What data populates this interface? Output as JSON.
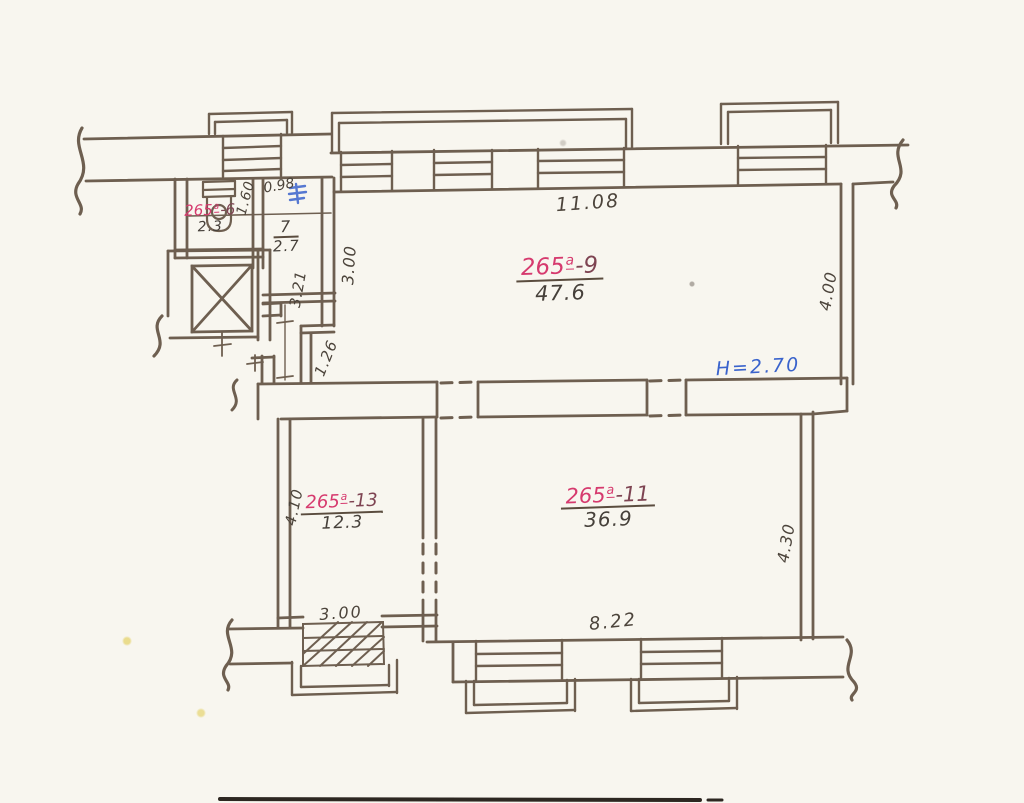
{
  "palette": {
    "ink": "#6e5f50",
    "red": "#d63a6e",
    "dark_red": "#7e4452",
    "blue": "#3a63cc",
    "paper": "#f8f6ef"
  },
  "rooms": {
    "wc": {
      "prefix": "265",
      "sup": "a",
      "suffix": "-6",
      "area": "2.3"
    },
    "hall": {
      "number": "7",
      "area": "2.7"
    },
    "main_upper": {
      "prefix": "265",
      "sup": "a",
      "suffix": "-9",
      "area": "47.6"
    },
    "lower_right": {
      "prefix": "265",
      "sup": "a",
      "suffix": "-11",
      "area": "36.9"
    },
    "lower_left": {
      "prefix": "265",
      "sup": "a",
      "suffix": "-13",
      "area": "12.3"
    }
  },
  "dimensions": {
    "wc_width": "0.98",
    "wc_depth": "1.60",
    "hall_depth": "3.21",
    "upper_left_niche": "3.00",
    "passage": "1.26",
    "top_width": "11.08",
    "upper_right_depth": "4.00",
    "lower_left_depth": "4.10",
    "lower_right_depth": "4.30",
    "entrance_width": "3.00",
    "bottom_width": "8.22"
  },
  "annotations": {
    "ceiling_height": "H=2.70"
  }
}
